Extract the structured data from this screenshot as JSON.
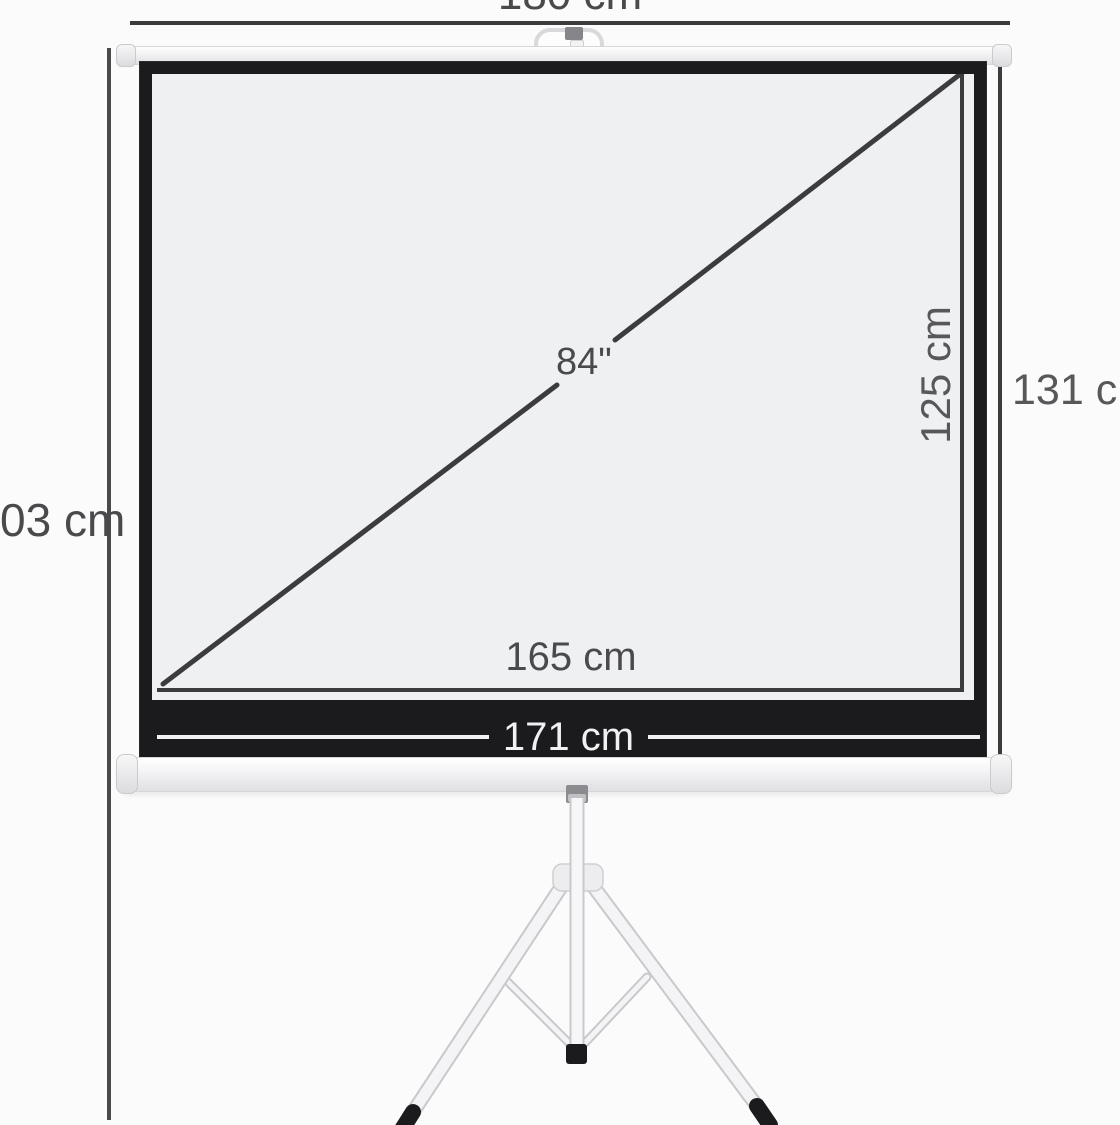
{
  "diagram": {
    "type": "product-dimension-diagram",
    "subject": "tripod projection screen front view with measurement lines"
  },
  "labels": {
    "overall_width": "180 cm",
    "case_width": "171 cm",
    "viewing_width": "165 cm",
    "viewing_height": "125 cm",
    "screen_height": "131 cm",
    "diagonal": "84\"",
    "stand_height_partial": "03 cm"
  },
  "colors": {
    "bg": "#fbfbfb",
    "line": "#3c3c3e",
    "label": "#4a4a4c",
    "frame": "#1b1b1d",
    "surface": "#eff0f2",
    "light": "#f1f1f2"
  }
}
